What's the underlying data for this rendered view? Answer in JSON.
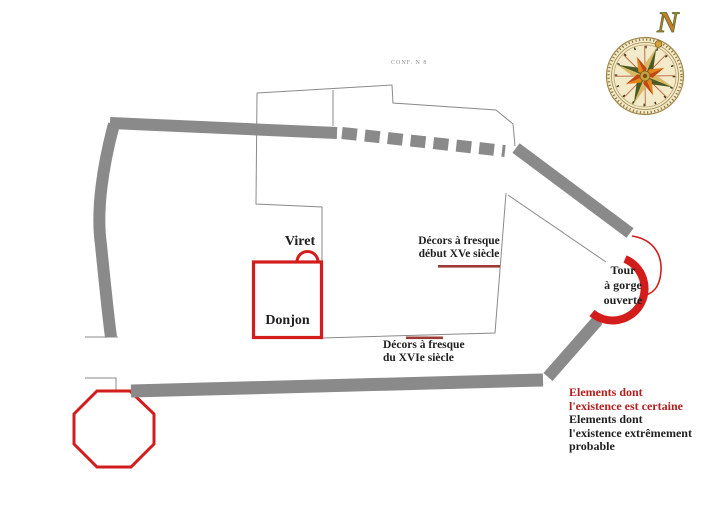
{
  "notes": {
    "conf": "CONF. N 8"
  },
  "map": {
    "viret_label": "Viret",
    "donjon_label": "Donjon",
    "fresque_xv": {
      "line1": "Décors à fresque",
      "line2": "début XVe siècle"
    },
    "fresque_xvi": {
      "line1": "Décors à fresque",
      "line2": "du XVIe siècle"
    },
    "tour": {
      "line1": "Tour",
      "line2": "à gorge",
      "line3": "ouverte"
    }
  },
  "compass": {
    "north_label": "N"
  },
  "legend": {
    "certain_line1": "Elements dont",
    "certain_line2": "l'existence est certaine",
    "probable_line1": "Elements dont",
    "probable_line2": "l'existence extrêmement",
    "probable_line3": "probable"
  },
  "colors": {
    "certain_red": "#d31c1c",
    "legend_red": "#b51f1f",
    "probable_black": "#1f1f1f",
    "wall_gray": "#8a8a8a",
    "fresco_marker_maroon": "#9c3a36",
    "compass_face": "#f3eac9"
  }
}
